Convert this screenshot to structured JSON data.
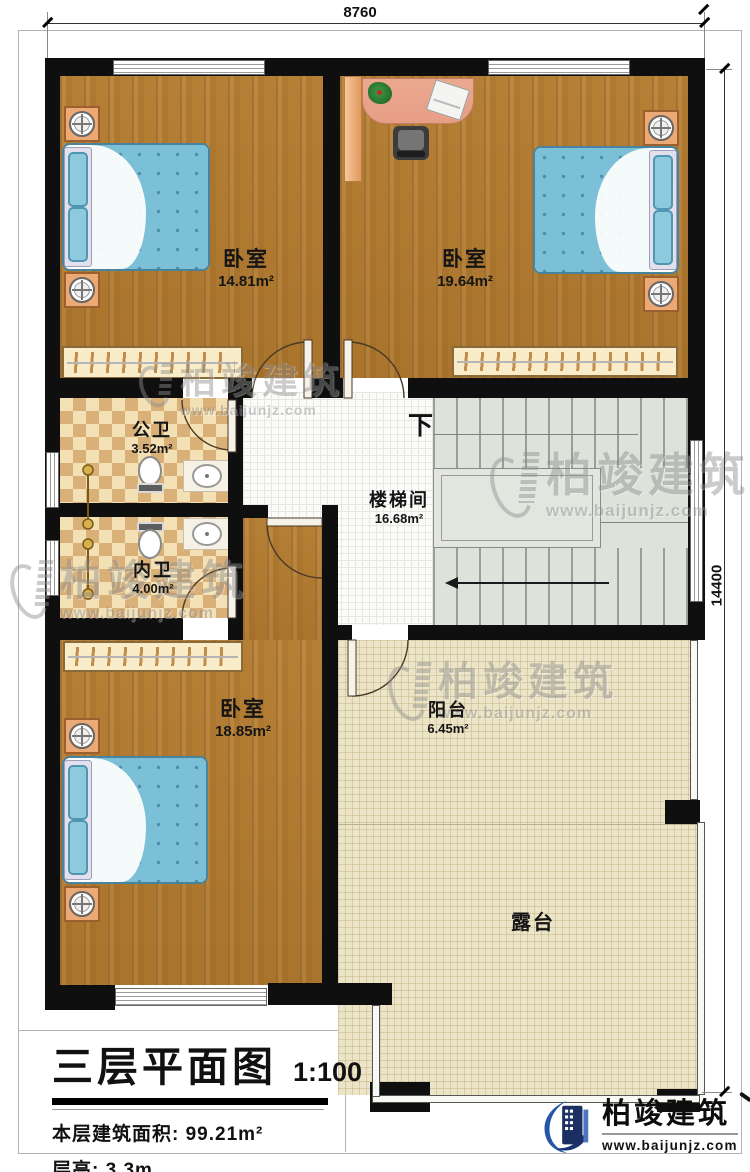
{
  "dimensions": {
    "top": "8760",
    "right": "14400"
  },
  "rooms": [
    {
      "name": "卧室",
      "area": "14.81m²"
    },
    {
      "name": "卧室",
      "area": "19.64m²"
    },
    {
      "name": "公卫",
      "area": "3.52m²"
    },
    {
      "name": "内卫",
      "area": "4.00m²"
    },
    {
      "name": "楼梯间",
      "area": "16.68m²"
    },
    {
      "name": "卧室",
      "area": "18.85m²"
    },
    {
      "name": "阳台",
      "area": "6.45m²"
    },
    {
      "name": "露台",
      "area": ""
    }
  ],
  "stairs": {
    "down_label": "下"
  },
  "title_block": {
    "title": "三层平面图",
    "scale": "1:100",
    "area_line": "本层建筑面积: 99.21m²",
    "height_line": "层高: 3.3m"
  },
  "brand": {
    "company": "柏竣建筑",
    "website": "www.baijunjz.com"
  },
  "watermark": {
    "company": "柏竣建筑",
    "website": "www.baijunjz.com"
  },
  "colors": {
    "wall": "#0f0f0f",
    "wood_floor": "#b27c33",
    "tile_light": "#f3e0b4",
    "tile_dark": "#d9b077",
    "corridor_tile": "#fbfbfa",
    "stair": "#dde2da",
    "outdoor_tile": "#ece4c7",
    "bed_blue": "#7cc0d8",
    "nightstand_orange": "#eda973",
    "desk_salmon": "#eba98f",
    "logo_blue": "#2456a8"
  }
}
